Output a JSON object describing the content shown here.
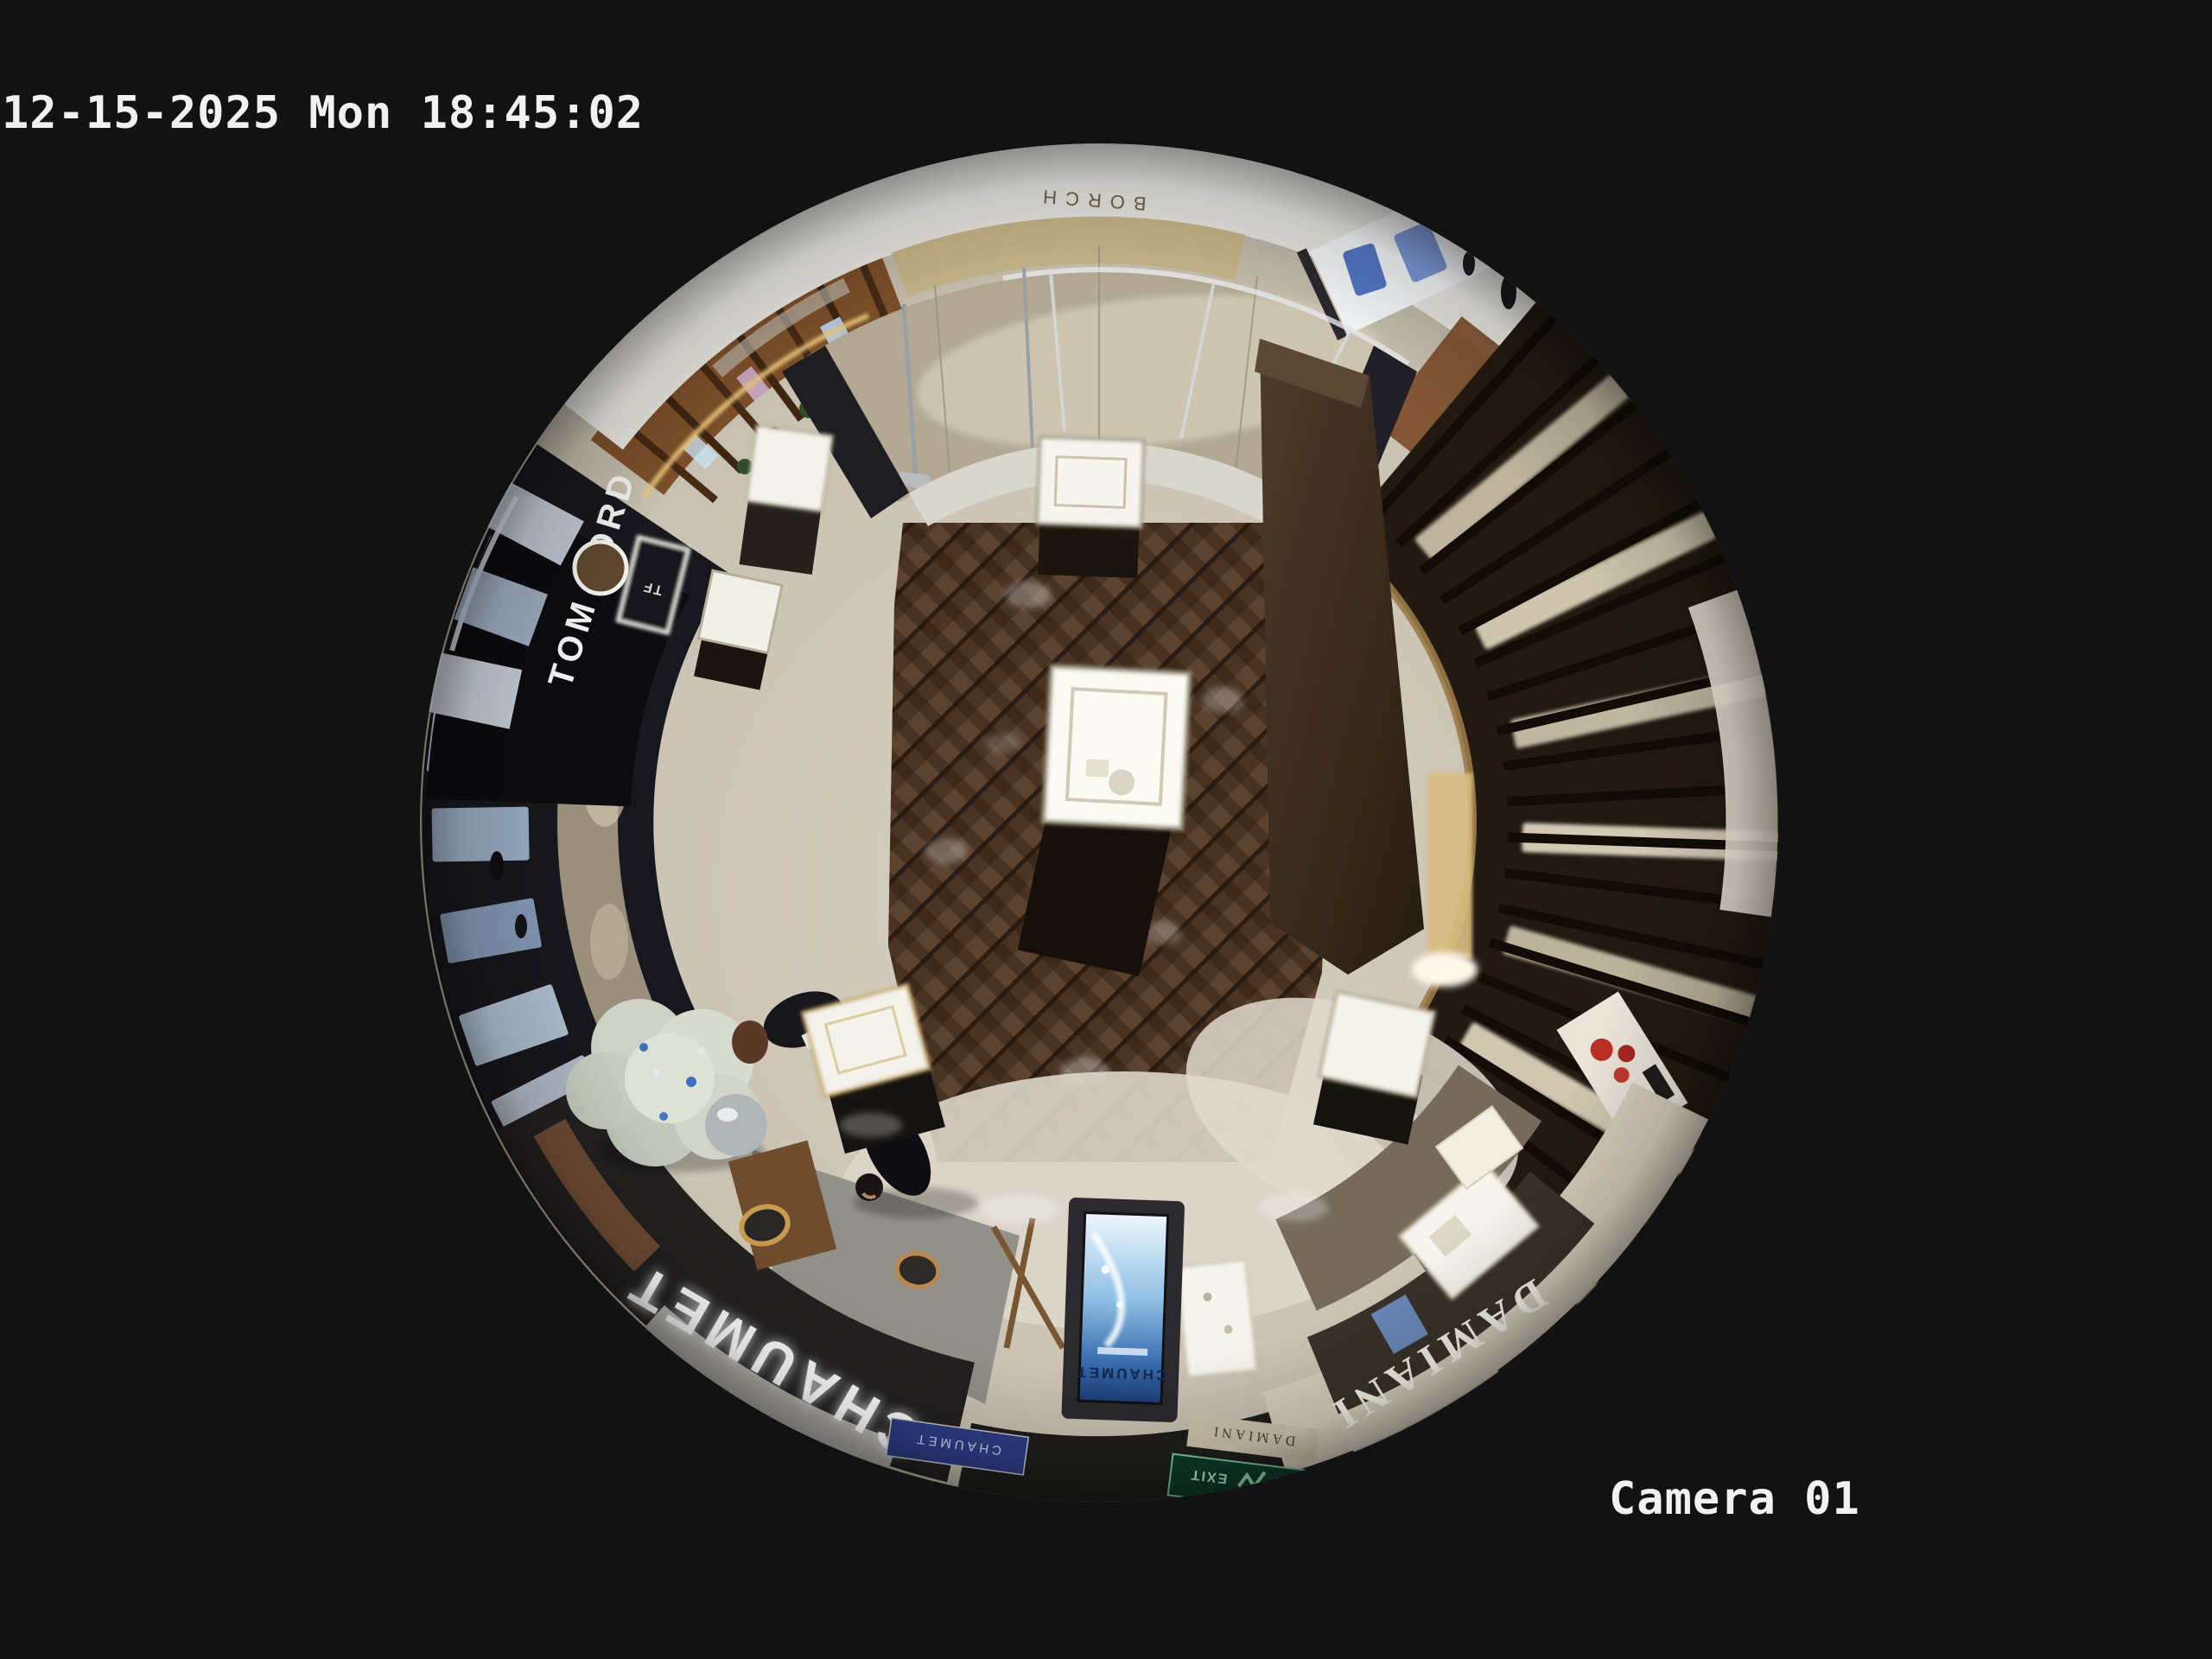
{
  "osd": {
    "timestamp": "12-15-2025 Mon 18:45:02",
    "camera_label": "Camera 01",
    "text_color": "#f1f1ef"
  },
  "signs": {
    "tom_ford": "TOM FORD",
    "tf_monogram": "TF",
    "mall_brand": "BORCH",
    "chaumet_fascia": "CHAUMET",
    "chaumet_plaque": "CHAUMET",
    "chaumet_screen": "CHAUMET",
    "damiani_fascia": "DAMIANI",
    "damiani_small": "DAMIANI",
    "exit": "EXIT"
  },
  "colors": {
    "background": "#121212",
    "wood_floor": "#4a3424",
    "marble_corridor": "#b2a893",
    "white_rim": "#e9e7e1",
    "gold_fascia": "#c6b488",
    "slat_wall": "#221a11",
    "chaumet_sign_glow": "#ffffff",
    "damiani_text": "#f5f2e8",
    "exit_green": "#9fdcb8",
    "kiosk_screen_blue": "#7db8e0"
  }
}
